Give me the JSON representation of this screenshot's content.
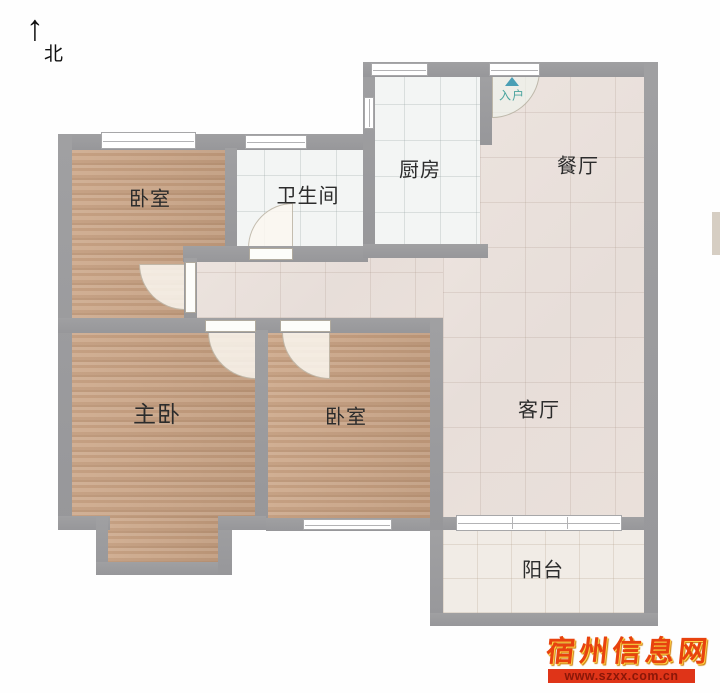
{
  "compass": {
    "label": "北",
    "arrow_icon": "up-arrow"
  },
  "rooms": {
    "bedroom_top": {
      "label": "卧室"
    },
    "bathroom": {
      "label": "卫生间"
    },
    "kitchen": {
      "label": "厨房"
    },
    "dining": {
      "label": "餐厅"
    },
    "master": {
      "label": "主卧"
    },
    "bedroom_mid": {
      "label": "卧室"
    },
    "living": {
      "label": "客厅"
    },
    "balcony": {
      "label": "阳台"
    }
  },
  "entrance": {
    "label": "入户",
    "marker_icon": "up-triangle"
  },
  "watermark": {
    "site_name": "宿州信息网",
    "site_url": "www.szxx.com.cn"
  },
  "colors": {
    "wall": "#9b9b9d",
    "wood_floor": "#c9a385",
    "tile_floor": "#e9e0da",
    "white_floor": "#f3f5f4",
    "balcony_floor": "#f1ece6",
    "entry_accent": "#4aa49e",
    "watermark_red": "#e8420e",
    "watermark_bar": "#df3418"
  }
}
